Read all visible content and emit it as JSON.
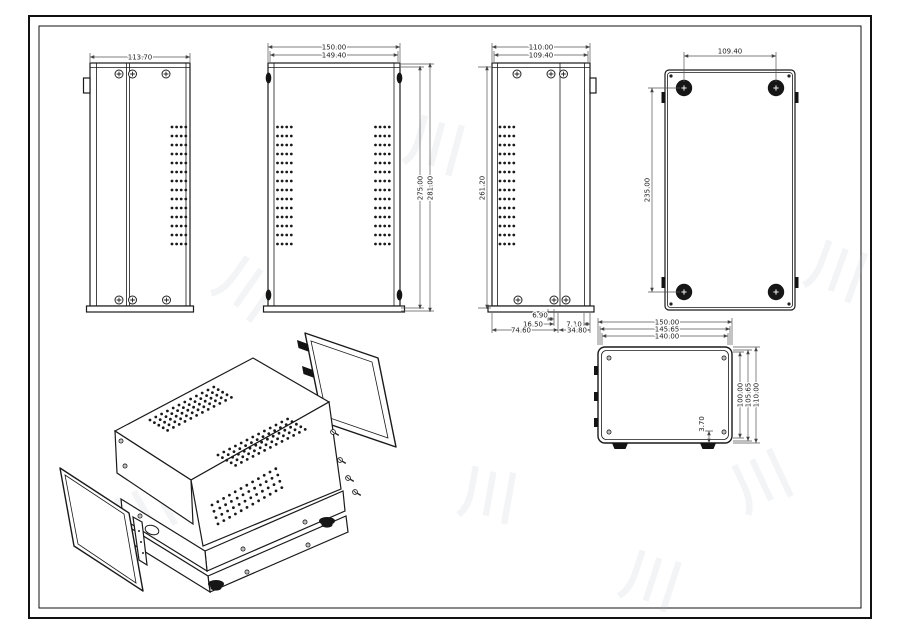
{
  "views": {
    "side_a": {
      "width": "113.70"
    },
    "top": {
      "width_outer": "150.00",
      "width_inner": "149.40",
      "depth_inner": "275.00",
      "depth_outer": "281.00"
    },
    "side_b": {
      "width_outer": "110.00",
      "width_inner": "109.40",
      "depth": "261.20",
      "bottom_dims": {
        "d1": "6.90",
        "d2": "16.50",
        "d3": "74.60",
        "d4": "7.10",
        "d5": "34.80"
      }
    },
    "bottom": {
      "foot_span_width": "109.40",
      "foot_span_depth": "235.00"
    },
    "front": {
      "width_outer": "150.00",
      "width_mid": "145.65",
      "width_inner": "140.00",
      "height_inner": "100.00",
      "height_mid": "105.65",
      "height_outer": "110.00",
      "lip": "3.70"
    }
  },
  "decor": {
    "watermark_glyph": "川"
  }
}
